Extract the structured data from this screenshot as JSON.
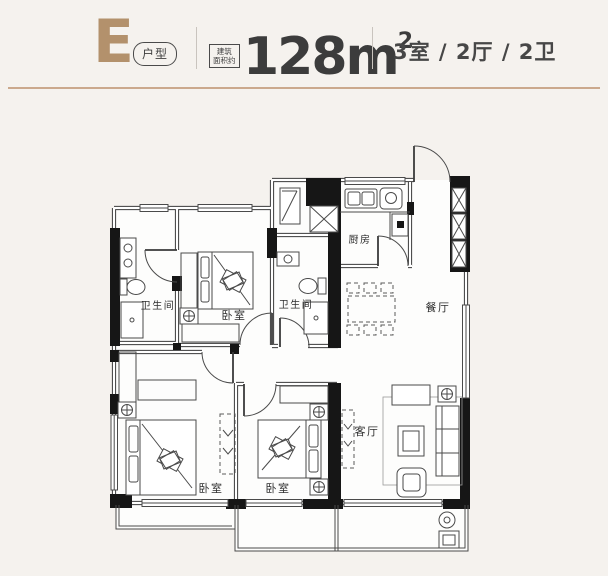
{
  "page": {
    "background": "#f5f2ee"
  },
  "header": {
    "unit_letter": "E",
    "unit_type_badge": "户型",
    "area_note_line1": "建筑",
    "area_note_line2": "面积约",
    "area_value": "128m",
    "area_superscript": "2",
    "spec": "3室 / 2厅 / 2卫",
    "accent_color": "#b3916c",
    "rule_color": "#cba98d"
  },
  "floorplan": {
    "labels": {
      "bathroom_left": "卫生间",
      "bathroom_middle": "卫生间",
      "bedroom_top": "卧室",
      "kitchen": "厨房",
      "dining": "餐厅",
      "bedroom_bottom_left": "卧室",
      "bedroom_bottom_middle": "卧室",
      "living": "客厅"
    }
  }
}
